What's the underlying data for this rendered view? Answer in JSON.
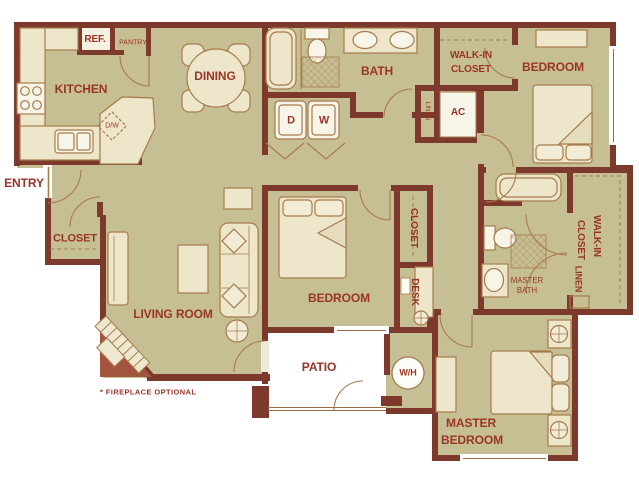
{
  "plan": {
    "type": "apartment-floor-plan",
    "colors": {
      "wall": "#7d392c",
      "floor": "#c7bf94",
      "furniture": "#ede6cb",
      "appliance": "#f7f4e8",
      "outline": "#a57b4c",
      "label_text": "#9a3427",
      "fireplace_brick": "#a3543e",
      "background": "#ffffff"
    },
    "labels": {
      "kitchen": "KITCHEN",
      "ref": "REF.",
      "pantry": "PANTRY",
      "dining": "DINING",
      "bath": "BATH",
      "walk_in_top_1": "WALK-IN",
      "walk_in_top_2": "CLOSET",
      "bedroom_top": "BEDROOM",
      "dryer": "D",
      "washer": "W",
      "linen_top": "LINEN",
      "ac": "AC",
      "entry": "ENTRY",
      "closet_entry": "CLOSET",
      "dishwasher": "D/W",
      "living_room": "LIVING ROOM",
      "bedroom_mid": "BEDROOM",
      "closet_mid": "CLOSET",
      "desk": "DESK",
      "master_bath_1": "MASTER",
      "master_bath_2": "BATH",
      "master_closet_1": "WALK-IN",
      "master_closet_2": "CLOSET",
      "master_linen": "LINEN",
      "patio": "PATIO",
      "water_heater": "W/H",
      "master_bedroom_1": "MASTER",
      "master_bedroom_2": "BEDROOM",
      "fireplace_note": "* FIREPLACE OPTIONAL"
    }
  }
}
